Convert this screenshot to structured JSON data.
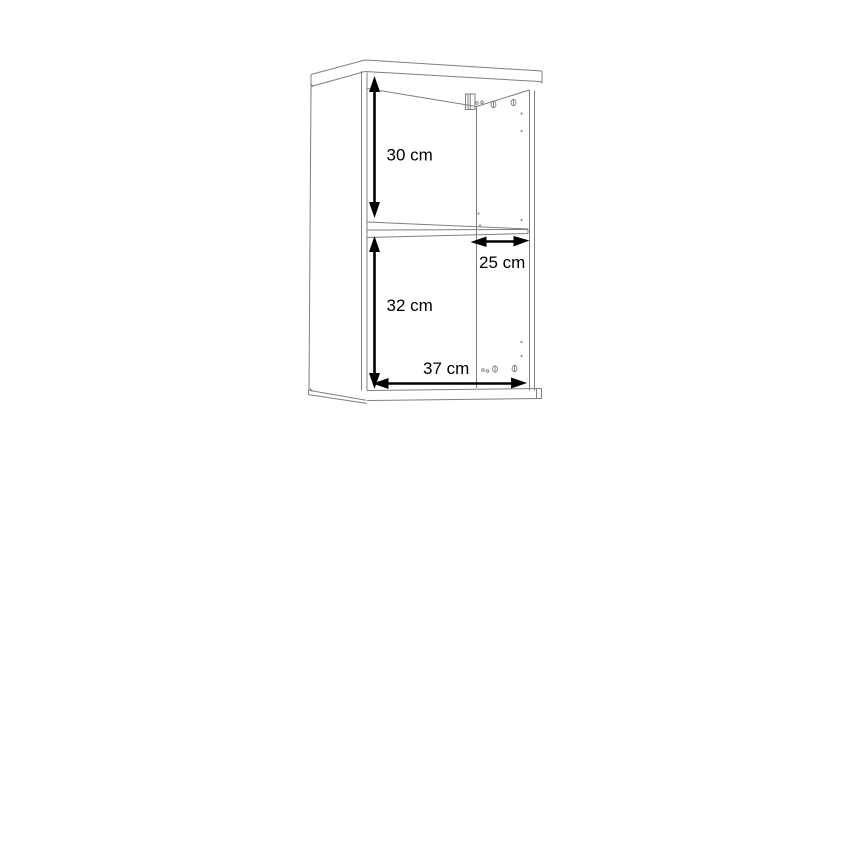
{
  "page": {
    "background_color": "#ffffff"
  },
  "diagram": {
    "type": "furniture-dimension-drawing",
    "subject": "wall cabinet with one shelf, perspective line drawing",
    "line_color": "#7f7f7f",
    "annotation_color": "#000000",
    "dimensions": [
      {
        "label": "30 cm",
        "orientation": "vertical",
        "region": "upper-compartment-height"
      },
      {
        "label": "25 cm",
        "orientation": "horizontal",
        "region": "shelf-depth"
      },
      {
        "label": "32 cm",
        "orientation": "vertical",
        "region": "lower-compartment-height"
      },
      {
        "label": "37 cm",
        "orientation": "horizontal",
        "region": "interior-width"
      }
    ]
  }
}
